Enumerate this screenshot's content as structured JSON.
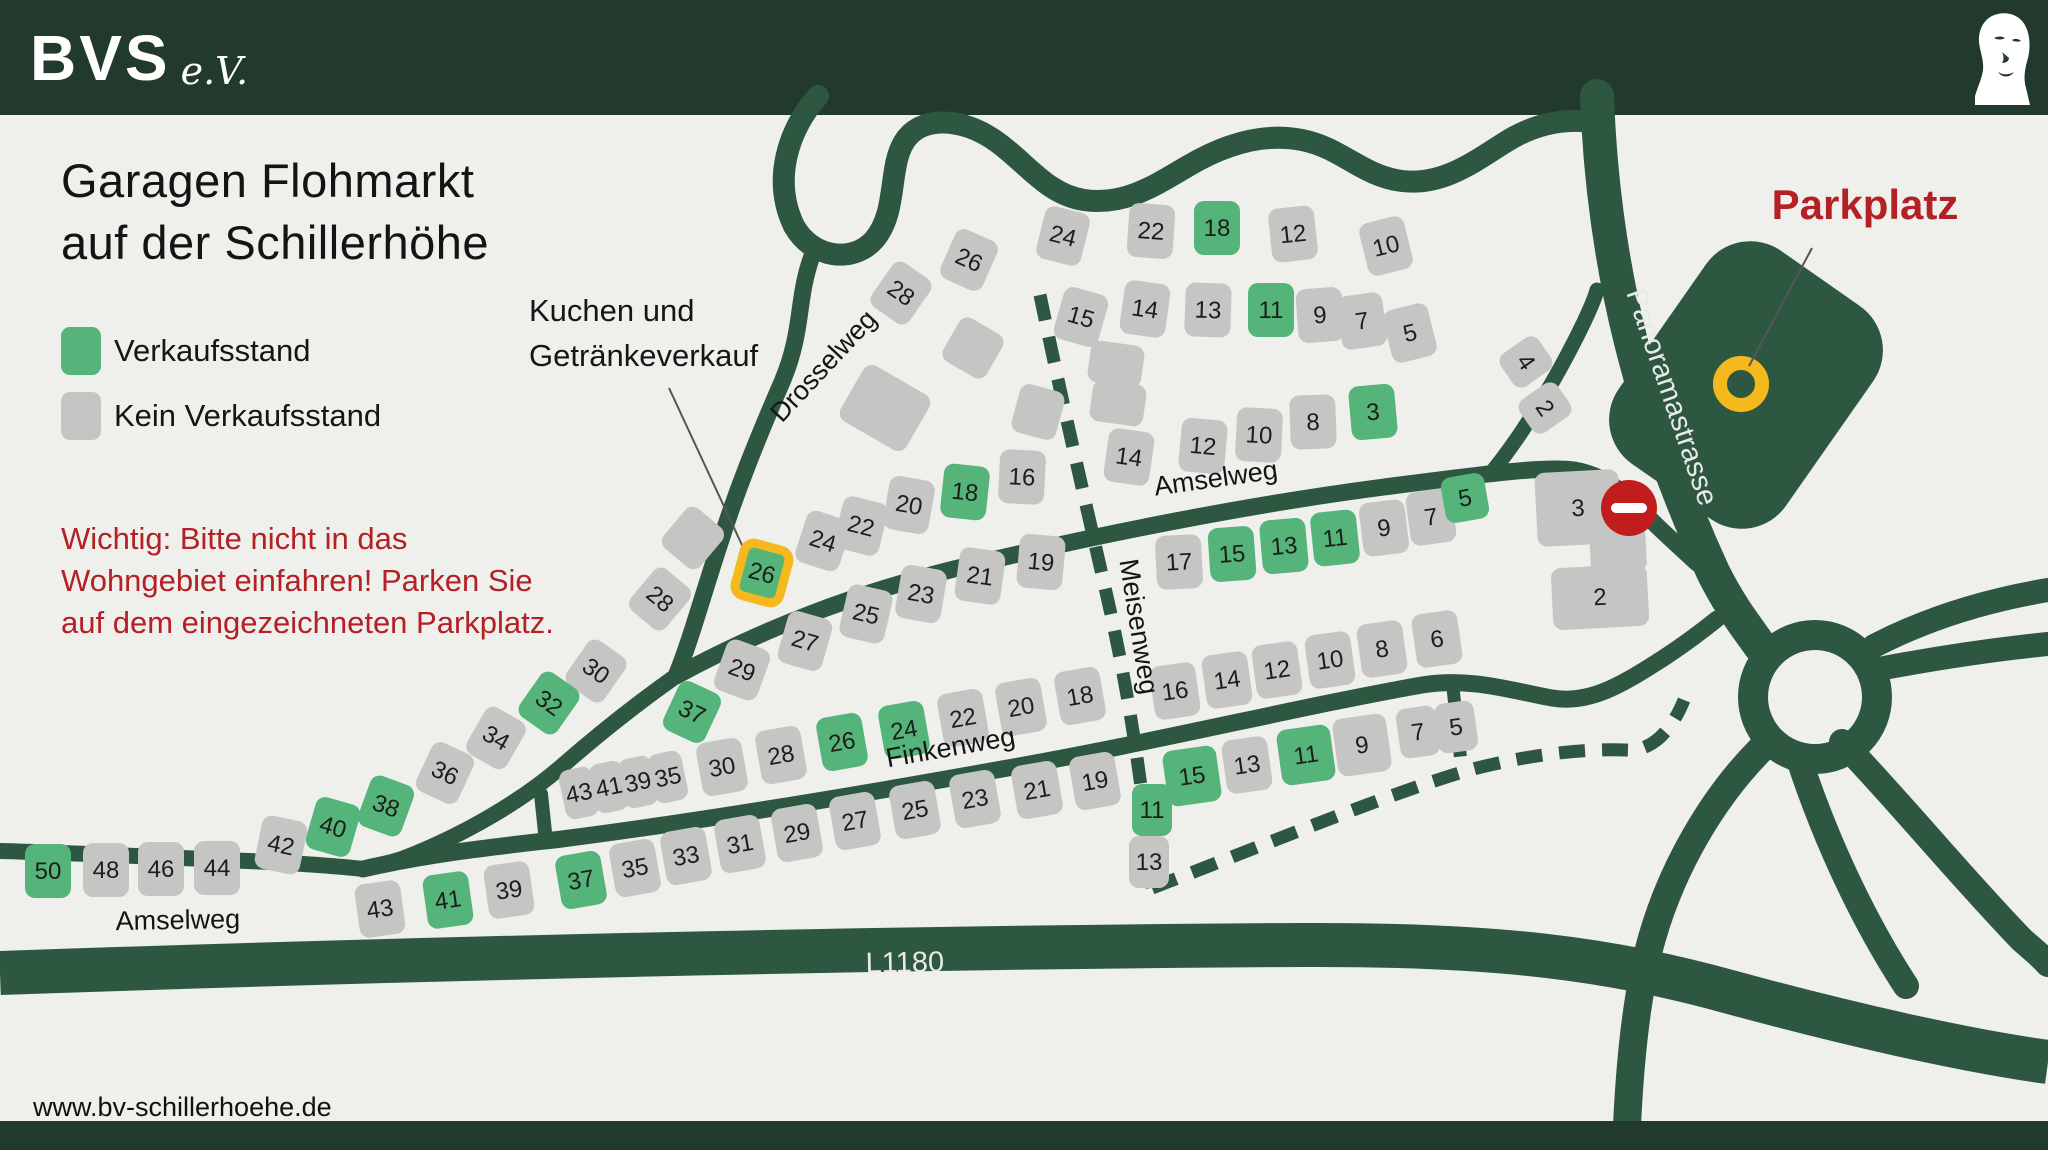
{
  "header": {
    "brand": "BVS",
    "brand_suffix": "e.V."
  },
  "title": {
    "line1": "Garagen Flohmarkt",
    "line2": "auf der Schillerhöhe"
  },
  "legend": [
    {
      "label": "Verkaufsstand",
      "type": "green"
    },
    {
      "label": "Kein Verkaufsstand",
      "type": "gray"
    }
  ],
  "annotations": {
    "kuchen": {
      "line1": "Kuchen und",
      "line2": "Getränkeverkauf"
    },
    "warning": [
      "Wichtig: Bitte nicht in das",
      "Wohngebiet einfahren! Parken Sie",
      "auf dem eingezeichneten Parkplatz."
    ],
    "parkplatz": "Parkplatz"
  },
  "footer": {
    "url": "www.bv-schillerhoehe.de"
  },
  "colors": {
    "background": "#efefec",
    "band": "#213a2b",
    "road": "#2d5741",
    "house_gray": "#c5c6c4",
    "house_green": "#55b47a",
    "highlight_yellow": "#f5b91e",
    "accent_red": "#b32025",
    "no_entry_red": "#c21d1d",
    "number_text": "#1d1d1b",
    "road_text": "#e9eae4"
  },
  "streets": [
    {
      "label": "Drosselweg",
      "x": 830,
      "y": 372,
      "rot": -47,
      "variant": "dark"
    },
    {
      "label": "Amselweg",
      "x": 1217,
      "y": 487,
      "rot": -8,
      "variant": "dark"
    },
    {
      "label": "Amselweg",
      "x": 178,
      "y": 929,
      "rot": -1,
      "variant": "dark"
    },
    {
      "label": "Finkenweg",
      "x": 952,
      "y": 756,
      "rot": -10,
      "variant": "dark"
    },
    {
      "label": "Meisenweg",
      "x": 1130,
      "y": 628,
      "rot": 81,
      "variant": "dark"
    },
    {
      "label": "Panoramastrasse",
      "x": 1663,
      "y": 400,
      "rot": 71,
      "variant": "light"
    },
    {
      "label": "L1180",
      "x": 905,
      "y": 972,
      "rot": -1,
      "variant": "light"
    }
  ],
  "map": {
    "legend_meaning": {
      "green": "Verkaufsstand",
      "gray": "Kein Verkaufsstand",
      "yellow_outline": "Kuchen und Getränkeverkauf"
    },
    "houses": [
      {
        "n": "28",
        "x": 901,
        "y": 293,
        "r": 35,
        "c": "n"
      },
      {
        "n": "26",
        "x": 969,
        "y": 260,
        "r": 24,
        "c": "n"
      },
      {
        "n": "24",
        "x": 1063,
        "y": 236,
        "r": 14,
        "c": "n"
      },
      {
        "n": "22",
        "x": 1151,
        "y": 231,
        "r": 4,
        "c": "n"
      },
      {
        "n": "18",
        "x": 1217,
        "y": 228,
        "r": 0,
        "c": "g"
      },
      {
        "n": "12",
        "x": 1293,
        "y": 234,
        "r": -6,
        "c": "n"
      },
      {
        "n": "10",
        "x": 1386,
        "y": 246,
        "r": -14,
        "c": "n"
      },
      {
        "n": "15",
        "x": 1081,
        "y": 317,
        "r": 16,
        "c": "n"
      },
      {
        "n": "14",
        "x": 1145,
        "y": 309,
        "r": 8,
        "c": "n"
      },
      {
        "n": "13",
        "x": 1208,
        "y": 310,
        "r": 2,
        "c": "n"
      },
      {
        "n": "11",
        "x": 1271,
        "y": 310,
        "r": 0,
        "c": "g"
      },
      {
        "n": "9",
        "x": 1320,
        "y": 315,
        "r": -4,
        "c": "n"
      },
      {
        "n": "7",
        "x": 1362,
        "y": 321,
        "r": -8,
        "c": "n"
      },
      {
        "n": "5",
        "x": 1410,
        "y": 333,
        "r": -14,
        "c": "n"
      },
      {
        "n": "14",
        "x": 1129,
        "y": 457,
        "r": 8,
        "c": "n"
      },
      {
        "n": "12",
        "x": 1203,
        "y": 446,
        "r": 5,
        "c": "n"
      },
      {
        "n": "10",
        "x": 1259,
        "y": 435,
        "r": 3,
        "c": "n"
      },
      {
        "n": "8",
        "x": 1313,
        "y": 422,
        "r": -2,
        "c": "n"
      },
      {
        "n": "3",
        "x": 1373,
        "y": 412,
        "r": -5,
        "c": "g"
      },
      {
        "n": "4",
        "x": 1526,
        "y": 362,
        "r": 55,
        "c": "n",
        "w": 40,
        "h": 46
      },
      {
        "n": "2",
        "x": 1545,
        "y": 408,
        "r": 55,
        "c": "n",
        "w": 40,
        "h": 46
      },
      {
        "n": "24",
        "x": 823,
        "y": 541,
        "r": 18,
        "c": "n"
      },
      {
        "n": "22",
        "x": 861,
        "y": 526,
        "r": 14,
        "c": "n"
      },
      {
        "n": "20",
        "x": 909,
        "y": 505,
        "r": 10,
        "c": "n"
      },
      {
        "n": "18",
        "x": 965,
        "y": 492,
        "r": 6,
        "c": "g"
      },
      {
        "n": "16",
        "x": 1022,
        "y": 477,
        "r": 3,
        "c": "n"
      },
      {
        "n": "26",
        "x": 762,
        "y": 573,
        "r": 15,
        "c": "y"
      },
      {
        "n": "28",
        "x": 660,
        "y": 599,
        "r": 40,
        "c": "n"
      },
      {
        "n": "29",
        "x": 742,
        "y": 670,
        "r": 20,
        "c": "n"
      },
      {
        "n": "27",
        "x": 805,
        "y": 641,
        "r": 16,
        "c": "n"
      },
      {
        "n": "25",
        "x": 866,
        "y": 614,
        "r": 13,
        "c": "n"
      },
      {
        "n": "23",
        "x": 921,
        "y": 594,
        "r": 10,
        "c": "n"
      },
      {
        "n": "21",
        "x": 980,
        "y": 576,
        "r": 8,
        "c": "n"
      },
      {
        "n": "19",
        "x": 1041,
        "y": 562,
        "r": 5,
        "c": "n"
      },
      {
        "n": "17",
        "x": 1179,
        "y": 562,
        "r": -3,
        "c": "n"
      },
      {
        "n": "15",
        "x": 1232,
        "y": 554,
        "r": -4,
        "c": "g"
      },
      {
        "n": "13",
        "x": 1284,
        "y": 546,
        "r": -5,
        "c": "g"
      },
      {
        "n": "11",
        "x": 1335,
        "y": 538,
        "r": -6,
        "c": "g"
      },
      {
        "n": "9",
        "x": 1384,
        "y": 528,
        "r": -7,
        "c": "n"
      },
      {
        "n": "7",
        "x": 1431,
        "y": 517,
        "r": -8,
        "c": "n"
      },
      {
        "n": "5",
        "x": 1465,
        "y": 498,
        "r": -10,
        "c": "g",
        "w": 44,
        "h": 46
      },
      {
        "n": "3",
        "x": 1578,
        "y": 508,
        "r": -3,
        "c": "n",
        "w": 84,
        "h": 74
      },
      {
        "n": "",
        "x": 1618,
        "y": 548,
        "r": -3,
        "c": "n",
        "w": 56,
        "h": 50
      },
      {
        "n": "2",
        "x": 1600,
        "y": 597,
        "r": -3,
        "c": "n",
        "w": 96,
        "h": 62
      },
      {
        "n": "30",
        "x": 596,
        "y": 671,
        "r": 35,
        "c": "n"
      },
      {
        "n": "32",
        "x": 549,
        "y": 703,
        "r": 35,
        "c": "g"
      },
      {
        "n": "37",
        "x": 692,
        "y": 712,
        "r": 25,
        "c": "g"
      },
      {
        "n": "34",
        "x": 496,
        "y": 738,
        "r": 30,
        "c": "n"
      },
      {
        "n": "36",
        "x": 445,
        "y": 773,
        "r": 25,
        "c": "n"
      },
      {
        "n": "38",
        "x": 386,
        "y": 806,
        "r": 20,
        "c": "g"
      },
      {
        "n": "40",
        "x": 333,
        "y": 827,
        "r": 16,
        "c": "g"
      },
      {
        "n": "42",
        "x": 281,
        "y": 845,
        "r": 12,
        "c": "n"
      },
      {
        "n": "44",
        "x": 217,
        "y": 868,
        "r": 0,
        "c": "n"
      },
      {
        "n": "46",
        "x": 161,
        "y": 869,
        "r": 0,
        "c": "n"
      },
      {
        "n": "48",
        "x": 106,
        "y": 870,
        "r": 0,
        "c": "n"
      },
      {
        "n": "50",
        "x": 48,
        "y": 871,
        "r": 0,
        "c": "g"
      },
      {
        "n": "43",
        "x": 579,
        "y": 793,
        "r": -12,
        "c": "n",
        "w": 34,
        "h": 50
      },
      {
        "n": "41",
        "x": 609,
        "y": 787,
        "r": -12,
        "c": "n",
        "w": 34,
        "h": 50
      },
      {
        "n": "39",
        "x": 638,
        "y": 782,
        "r": -12,
        "c": "n",
        "w": 34,
        "h": 50
      },
      {
        "n": "35",
        "x": 668,
        "y": 777,
        "r": -12,
        "c": "n",
        "w": 34,
        "h": 50
      },
      {
        "n": "30",
        "x": 722,
        "y": 767,
        "r": -10,
        "c": "n"
      },
      {
        "n": "28",
        "x": 781,
        "y": 755,
        "r": -10,
        "c": "n"
      },
      {
        "n": "26",
        "x": 842,
        "y": 742,
        "r": -10,
        "c": "g"
      },
      {
        "n": "24",
        "x": 904,
        "y": 730,
        "r": -10,
        "c": "g"
      },
      {
        "n": "22",
        "x": 963,
        "y": 718,
        "r": -10,
        "c": "n"
      },
      {
        "n": "20",
        "x": 1021,
        "y": 707,
        "r": -10,
        "c": "n"
      },
      {
        "n": "18",
        "x": 1080,
        "y": 696,
        "r": -10,
        "c": "n"
      },
      {
        "n": "37",
        "x": 581,
        "y": 880,
        "r": -10,
        "c": "g"
      },
      {
        "n": "35",
        "x": 635,
        "y": 868,
        "r": -10,
        "c": "n"
      },
      {
        "n": "33",
        "x": 686,
        "y": 856,
        "r": -10,
        "c": "n"
      },
      {
        "n": "31",
        "x": 740,
        "y": 844,
        "r": -10,
        "c": "n"
      },
      {
        "n": "29",
        "x": 797,
        "y": 833,
        "r": -10,
        "c": "n"
      },
      {
        "n": "27",
        "x": 855,
        "y": 821,
        "r": -10,
        "c": "n"
      },
      {
        "n": "25",
        "x": 915,
        "y": 810,
        "r": -10,
        "c": "n"
      },
      {
        "n": "23",
        "x": 975,
        "y": 799,
        "r": -10,
        "c": "n"
      },
      {
        "n": "21",
        "x": 1037,
        "y": 790,
        "r": -10,
        "c": "n"
      },
      {
        "n": "19",
        "x": 1095,
        "y": 781,
        "r": -10,
        "c": "n"
      },
      {
        "n": "43",
        "x": 380,
        "y": 909,
        "r": -8,
        "c": "n"
      },
      {
        "n": "41",
        "x": 448,
        "y": 900,
        "r": -8,
        "c": "g"
      },
      {
        "n": "39",
        "x": 509,
        "y": 890,
        "r": -8,
        "c": "n"
      },
      {
        "n": "16",
        "x": 1175,
        "y": 691,
        "r": -8,
        "c": "n"
      },
      {
        "n": "14",
        "x": 1227,
        "y": 680,
        "r": -8,
        "c": "n"
      },
      {
        "n": "12",
        "x": 1277,
        "y": 670,
        "r": -8,
        "c": "n"
      },
      {
        "n": "10",
        "x": 1330,
        "y": 660,
        "r": -8,
        "c": "n"
      },
      {
        "n": "8",
        "x": 1382,
        "y": 649,
        "r": -8,
        "c": "n"
      },
      {
        "n": "6",
        "x": 1437,
        "y": 639,
        "r": -8,
        "c": "n"
      },
      {
        "n": "15",
        "x": 1192,
        "y": 776,
        "r": -8,
        "c": "g",
        "w": 54,
        "h": 56
      },
      {
        "n": "13",
        "x": 1247,
        "y": 765,
        "r": -8,
        "c": "n"
      },
      {
        "n": "11",
        "x": 1306,
        "y": 755,
        "r": -8,
        "c": "g",
        "w": 54,
        "h": 56
      },
      {
        "n": "9",
        "x": 1362,
        "y": 745,
        "r": -8,
        "c": "n",
        "w": 54,
        "h": 58
      },
      {
        "n": "7",
        "x": 1418,
        "y": 732,
        "r": -8,
        "c": "n",
        "w": 40,
        "h": 50
      },
      {
        "n": "5",
        "x": 1456,
        "y": 727,
        "r": -8,
        "c": "n",
        "w": 40,
        "h": 50
      },
      {
        "n": "11",
        "x": 1152,
        "y": 810,
        "r": 0,
        "c": "g",
        "w": 40,
        "h": 52
      },
      {
        "n": "13",
        "x": 1149,
        "y": 862,
        "r": 0,
        "c": "n",
        "w": 40,
        "h": 52
      },
      {
        "n": "",
        "x": 885,
        "y": 408,
        "r": 30,
        "c": "n",
        "w": 76,
        "h": 64
      },
      {
        "n": "",
        "x": 973,
        "y": 348,
        "r": 30,
        "c": "n",
        "w": 50,
        "h": 50
      },
      {
        "n": "",
        "x": 1038,
        "y": 412,
        "r": 15,
        "c": "n",
        "w": 46,
        "h": 50
      },
      {
        "n": "",
        "x": 693,
        "y": 538,
        "r": 40,
        "c": "n",
        "w": 48,
        "h": 52
      },
      {
        "n": "",
        "x": 1116,
        "y": 364,
        "r": 8,
        "c": "n",
        "w": 54,
        "h": 42
      },
      {
        "n": "",
        "x": 1118,
        "y": 403,
        "r": 8,
        "c": "n",
        "w": 54,
        "h": 42
      }
    ]
  }
}
